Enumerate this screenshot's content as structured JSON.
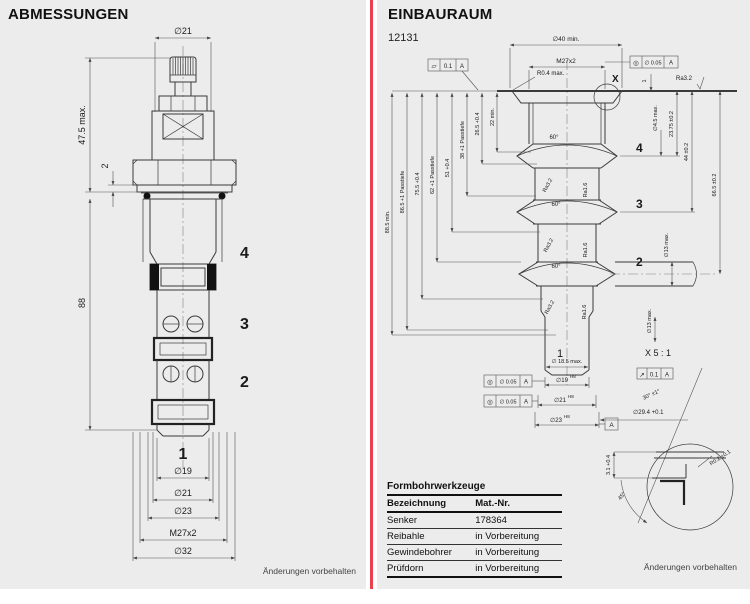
{
  "page": {
    "left_footer": "Änderungen vorbehalten",
    "right_footer": "Änderungen vorbehalten"
  },
  "abmessungen": {
    "title": "ABMESSUNGEN",
    "dims": {
      "d21_top": "∅21",
      "h_max": "47.5 max.",
      "washer": "2",
      "length": "88",
      "d19": "∅19",
      "d21": "∅21",
      "d23": "∅23",
      "thread": "M27x2",
      "d32": "∅32"
    },
    "ports": {
      "p4": "4",
      "p3": "3",
      "p2": "2",
      "p1": "1"
    }
  },
  "einbauraum": {
    "title": "EINBAURAUM",
    "drawing_no": "12131",
    "top_dims": {
      "d40": "∅40 min.",
      "thread": "M27x2",
      "r04": "R0.4 max.",
      "x_label": "X",
      "dim_1": "1",
      "ra32_face": "Ra3.2"
    },
    "fcf_flatness": {
      "sym": "▱",
      "tol": "0.1",
      "datum": "A"
    },
    "fcf_conc_top": {
      "sym": "◎",
      "tol": "∅ 0.05",
      "datum": "A"
    },
    "fcf_conc_1": {
      "sym": "◎",
      "tol": "∅ 0.05",
      "datum": "A"
    },
    "fcf_conc_2": {
      "sym": "◎",
      "tol": "∅ 0.05",
      "datum": "A"
    },
    "fcf_runout": {
      "sym": "↗",
      "tol": "0.1",
      "datum": "A"
    },
    "depth_dims": [
      "88.5 min.",
      "86.5 +1 Passtiefe",
      "75.5 +0.4",
      "62 +1 Passtiefe",
      "51 +0.4",
      "38 +1 Passtiefe",
      "26.5 +0.4",
      "22 min."
    ],
    "side_dims": {
      "d45": "∅4.5 max.",
      "d2375": "23.75 ±0.2",
      "d44": "44 ±0.2",
      "d665": "66.5 ±0.2",
      "d13a": "∅13 max.",
      "d13b": "∅13 max."
    },
    "groove_angles": [
      "60°",
      "60°",
      "60°"
    ],
    "surface": {
      "ra32": "Ra3.2",
      "ra16": "Ra1.6"
    },
    "ports": {
      "p4": "4",
      "p3": "3",
      "p2": "2",
      "p1": "1"
    },
    "bore_dims": {
      "d185": "∅ 18.5 max.",
      "d19": "∅19",
      "d19_sup": "H8",
      "d21": "∅21",
      "d21_sup": "H8",
      "d23": "∅23",
      "d23_sup": "H8",
      "datum_a": "A",
      "d294": "∅29.4 +0.1",
      "angle30": "30° ±1°"
    },
    "detail": {
      "title": "X 5 : 1",
      "depth": "3.1 +0.4",
      "angle": "45°",
      "radius": "R0.2 ±0.1"
    },
    "table": {
      "title": "Formbohrwerkzeuge",
      "headers": [
        "Bezeichnung",
        "Mat.-Nr."
      ],
      "rows": [
        [
          "Senker",
          "178364"
        ],
        [
          "Reibahle",
          "in Vorbereitung"
        ],
        [
          "Gewindebohrer",
          "in Vorbereitung"
        ],
        [
          "Prüfdorn",
          "in Vorbereitung"
        ]
      ]
    }
  }
}
